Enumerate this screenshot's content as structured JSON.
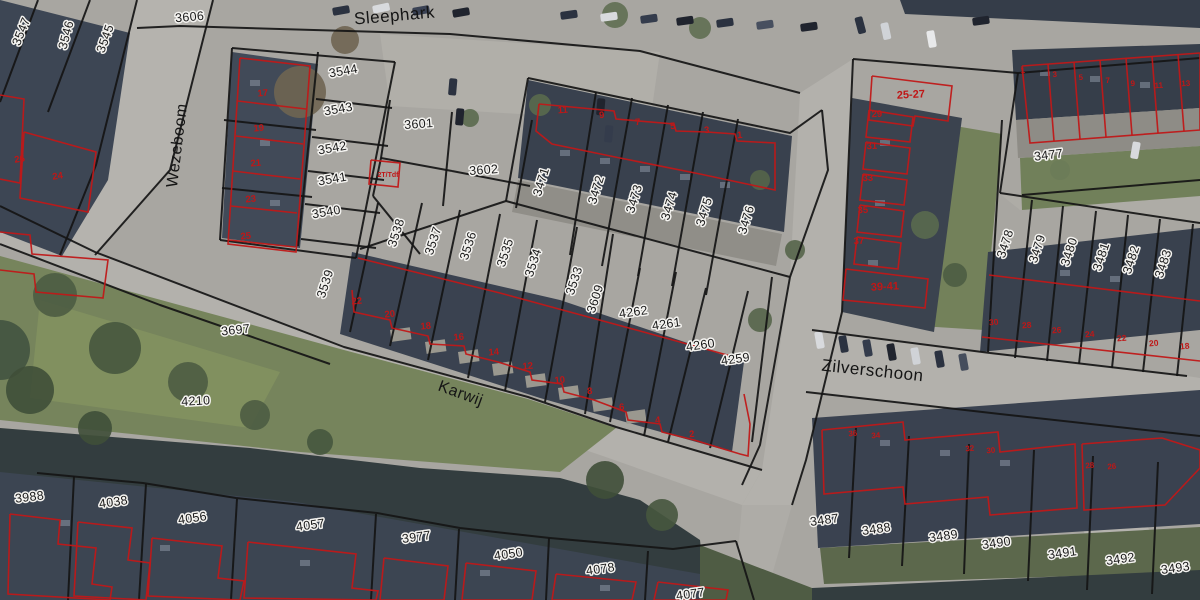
{
  "map_title": "aerial cadastral map",
  "colors": {
    "parcel_line": "#151515",
    "building_line": "#c01818",
    "parcel_label": "#1b1b1b",
    "label_halo": "#f4f3f0",
    "house_number": "#bf1717",
    "pavement": "#a8a6a1",
    "roof_dark": "#39414e",
    "grass": "#76845c",
    "water": "#333d3f"
  },
  "streets": [
    {
      "t": "Sleephark",
      "x": 395,
      "y": 21,
      "r": -5,
      "s": 17
    },
    {
      "t": "Wezeboom",
      "x": 182,
      "y": 146,
      "r": -83,
      "s": 16
    },
    {
      "t": "Karwij",
      "x": 459,
      "y": 398,
      "r": 20,
      "s": 16
    },
    {
      "t": "Zilverschoon",
      "x": 872,
      "y": 376,
      "r": 6,
      "s": 17
    }
  ],
  "parcels": [
    {
      "t": "3547",
      "x": 25,
      "y": 33,
      "r": -68
    },
    {
      "t": "3546",
      "x": 70,
      "y": 36,
      "r": -75
    },
    {
      "t": "3545",
      "x": 109,
      "y": 40,
      "r": -70
    },
    {
      "t": "3606",
      "x": 190,
      "y": 21,
      "r": -5
    },
    {
      "t": "3544",
      "x": 344,
      "y": 75,
      "r": -10
    },
    {
      "t": "3543",
      "x": 339,
      "y": 113,
      "r": -10
    },
    {
      "t": "3542",
      "x": 333,
      "y": 152,
      "r": -10
    },
    {
      "t": "3541",
      "x": 333,
      "y": 183,
      "r": -10
    },
    {
      "t": "3540",
      "x": 327,
      "y": 216,
      "r": -10
    },
    {
      "t": "3601",
      "x": 419,
      "y": 128,
      "r": -4
    },
    {
      "t": "3602",
      "x": 484,
      "y": 174,
      "r": -4
    },
    {
      "t": "3471",
      "x": 545,
      "y": 183,
      "r": -73
    },
    {
      "t": "3472",
      "x": 600,
      "y": 191,
      "r": -73
    },
    {
      "t": "3473",
      "x": 638,
      "y": 200,
      "r": -73
    },
    {
      "t": "3474",
      "x": 673,
      "y": 207,
      "r": -73
    },
    {
      "t": "3475",
      "x": 708,
      "y": 213,
      "r": -73
    },
    {
      "t": "3476",
      "x": 750,
      "y": 221,
      "r": -73
    },
    {
      "t": "3477",
      "x": 1049,
      "y": 159,
      "r": -7
    },
    {
      "t": "3478",
      "x": 1009,
      "y": 245,
      "r": -72
    },
    {
      "t": "3479",
      "x": 1041,
      "y": 250,
      "r": -72
    },
    {
      "t": "3480",
      "x": 1073,
      "y": 253,
      "r": -72
    },
    {
      "t": "3481",
      "x": 1105,
      "y": 258,
      "r": -72
    },
    {
      "t": "3482",
      "x": 1135,
      "y": 261,
      "r": -72
    },
    {
      "t": "3483",
      "x": 1167,
      "y": 265,
      "r": -72
    },
    {
      "t": "3539",
      "x": 329,
      "y": 285,
      "r": -72
    },
    {
      "t": "3538",
      "x": 400,
      "y": 234,
      "r": -72
    },
    {
      "t": "3537",
      "x": 437,
      "y": 242,
      "r": -72
    },
    {
      "t": "3536",
      "x": 472,
      "y": 247,
      "r": -72
    },
    {
      "t": "3535",
      "x": 509,
      "y": 254,
      "r": -72
    },
    {
      "t": "3534",
      "x": 537,
      "y": 264,
      "r": -72
    },
    {
      "t": "3533",
      "x": 578,
      "y": 282,
      "r": -72
    },
    {
      "t": "3609",
      "x": 599,
      "y": 300,
      "r": -72
    },
    {
      "t": "4262",
      "x": 634,
      "y": 316,
      "r": -8
    },
    {
      "t": "4261",
      "x": 667,
      "y": 328,
      "r": -8
    },
    {
      "t": "4260",
      "x": 701,
      "y": 349,
      "r": -8
    },
    {
      "t": "4259",
      "x": 736,
      "y": 363,
      "r": -8
    },
    {
      "t": "3697",
      "x": 236,
      "y": 334,
      "r": -6
    },
    {
      "t": "4210",
      "x": 196,
      "y": 405,
      "r": -3
    },
    {
      "t": "3988",
      "x": 30,
      "y": 501,
      "r": -7
    },
    {
      "t": "4038",
      "x": 114,
      "y": 506,
      "r": -8
    },
    {
      "t": "4056",
      "x": 193,
      "y": 522,
      "r": -8
    },
    {
      "t": "4057",
      "x": 311,
      "y": 529,
      "r": -8
    },
    {
      "t": "3977",
      "x": 417,
      "y": 541,
      "r": -8
    },
    {
      "t": "4050",
      "x": 509,
      "y": 558,
      "r": -8
    },
    {
      "t": "4078",
      "x": 601,
      "y": 573,
      "r": -8
    },
    {
      "t": "4077",
      "x": 691,
      "y": 598,
      "r": -8
    },
    {
      "t": "3487",
      "x": 825,
      "y": 524,
      "r": -8
    },
    {
      "t": "3488",
      "x": 877,
      "y": 533,
      "r": -8
    },
    {
      "t": "3489",
      "x": 944,
      "y": 540,
      "r": -8
    },
    {
      "t": "3490",
      "x": 997,
      "y": 547,
      "r": -8
    },
    {
      "t": "3491",
      "x": 1063,
      "y": 557,
      "r": -8
    },
    {
      "t": "3492",
      "x": 1121,
      "y": 563,
      "r": -8
    },
    {
      "t": "3493",
      "x": 1176,
      "y": 572,
      "r": -8
    }
  ],
  "house_numbers": [
    {
      "t": "26",
      "x": 20,
      "y": 162,
      "r": -8
    },
    {
      "t": "24",
      "x": 58,
      "y": 179,
      "r": -8
    },
    {
      "t": "17",
      "x": 263,
      "y": 96,
      "r": -5
    },
    {
      "t": "19",
      "x": 259,
      "y": 131,
      "r": -5
    },
    {
      "t": "21",
      "x": 256,
      "y": 166,
      "r": -5
    },
    {
      "t": "23",
      "x": 251,
      "y": 202,
      "r": -5
    },
    {
      "t": "25",
      "x": 246,
      "y": 239,
      "r": -5
    },
    {
      "t": "11",
      "x": 563,
      "y": 113,
      "r": -5
    },
    {
      "t": "9",
      "x": 602,
      "y": 118,
      "r": -5
    },
    {
      "t": "7",
      "x": 638,
      "y": 125,
      "r": -5
    },
    {
      "t": "5",
      "x": 673,
      "y": 129,
      "r": -5
    },
    {
      "t": "3",
      "x": 707,
      "y": 133,
      "r": -5
    },
    {
      "t": "1",
      "x": 740,
      "y": 138,
      "r": -5
    },
    {
      "t": "22",
      "x": 357,
      "y": 304,
      "r": -5
    },
    {
      "t": "20",
      "x": 390,
      "y": 317,
      "r": -5
    },
    {
      "t": "18",
      "x": 426,
      "y": 329,
      "r": -5
    },
    {
      "t": "16",
      "x": 459,
      "y": 340,
      "r": -5
    },
    {
      "t": "14",
      "x": 494,
      "y": 355,
      "r": -5
    },
    {
      "t": "12",
      "x": 528,
      "y": 369,
      "r": -5
    },
    {
      "t": "10",
      "x": 560,
      "y": 383,
      "r": -5
    },
    {
      "t": "8",
      "x": 590,
      "y": 394,
      "r": -5
    },
    {
      "t": "6",
      "x": 622,
      "y": 410,
      "r": -5
    },
    {
      "t": "4",
      "x": 658,
      "y": 423,
      "r": -5
    },
    {
      "t": "2",
      "x": 692,
      "y": 437,
      "r": -5
    },
    {
      "t": "25-27",
      "x": 911,
      "y": 98,
      "r": -3,
      "s": 11
    },
    {
      "t": "29",
      "x": 877,
      "y": 117,
      "r": -3
    },
    {
      "t": "31",
      "x": 872,
      "y": 149,
      "r": -3
    },
    {
      "t": "33",
      "x": 868,
      "y": 181,
      "r": -3
    },
    {
      "t": "35",
      "x": 863,
      "y": 213,
      "r": -3
    },
    {
      "t": "37",
      "x": 859,
      "y": 244,
      "r": -3
    },
    {
      "t": "39-41",
      "x": 885,
      "y": 290,
      "r": -3,
      "s": 11
    },
    {
      "t": "1",
      "x": 1023,
      "y": 73,
      "r": -4,
      "s": 8
    },
    {
      "t": "3",
      "x": 1055,
      "y": 77,
      "r": -4,
      "s": 8
    },
    {
      "t": "5",
      "x": 1081,
      "y": 80,
      "r": -4,
      "s": 8
    },
    {
      "t": "7",
      "x": 1108,
      "y": 83,
      "r": -4,
      "s": 8
    },
    {
      "t": "9",
      "x": 1133,
      "y": 86,
      "r": -4,
      "s": 8
    },
    {
      "t": "11",
      "x": 1159,
      "y": 88,
      "r": -4,
      "s": 8
    },
    {
      "t": "13",
      "x": 1186,
      "y": 86,
      "r": -4,
      "s": 8
    },
    {
      "t": "30",
      "x": 994,
      "y": 325,
      "r": -5,
      "s": 8.5
    },
    {
      "t": "28",
      "x": 1027,
      "y": 328,
      "r": -5,
      "s": 8.5
    },
    {
      "t": "26",
      "x": 1057,
      "y": 333,
      "r": -5,
      "s": 8.5
    },
    {
      "t": "24",
      "x": 1090,
      "y": 337,
      "r": -5,
      "s": 8.5
    },
    {
      "t": "22",
      "x": 1122,
      "y": 341,
      "r": -5,
      "s": 8.5
    },
    {
      "t": "20",
      "x": 1154,
      "y": 346,
      "r": -5,
      "s": 8.5
    },
    {
      "t": "18",
      "x": 1185,
      "y": 349,
      "r": -5,
      "s": 8.5
    },
    {
      "t": "36",
      "x": 853,
      "y": 436,
      "r": -5,
      "s": 8
    },
    {
      "t": "34",
      "x": 876,
      "y": 438,
      "r": -5,
      "s": 8
    },
    {
      "t": "32",
      "x": 970,
      "y": 451,
      "r": -5,
      "s": 8
    },
    {
      "t": "30",
      "x": 991,
      "y": 453,
      "r": -5,
      "s": 8
    },
    {
      "t": "28",
      "x": 1090,
      "y": 468,
      "r": -5,
      "s": 8
    },
    {
      "t": "26",
      "x": 1112,
      "y": 469,
      "r": -5,
      "s": 8
    },
    {
      "t": "2T/Tdf",
      "x": 388,
      "y": 177,
      "r": 0,
      "s": 7
    }
  ]
}
